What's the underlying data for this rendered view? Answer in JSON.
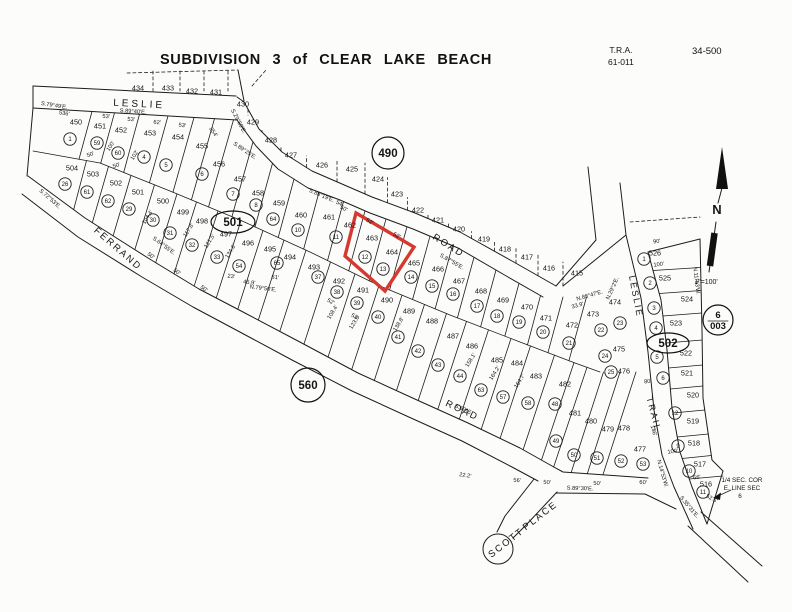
{
  "title": "SUBDIVISION 3 of CLEAR LAKE BEACH",
  "tra": {
    "label": "T.R.A.",
    "value": "61-011"
  },
  "sheet": "34-500",
  "map": {
    "north": {
      "label": "N"
    },
    "scale_note": "1\"=100'",
    "corner_note": [
      "1/4 SEC. COR",
      "E. LINE SEC",
      "6"
    ],
    "highlight": {
      "color": "#d43a2f",
      "points": "356,213 414,247 385,291 345,256",
      "lots": [
        "463",
        "464"
      ]
    },
    "refs": [
      {
        "t": "490",
        "x": 388,
        "y": 153,
        "shape": "circle",
        "rx": 16
      },
      {
        "t": "501",
        "x": 233,
        "y": 222,
        "shape": "ellipse",
        "rx": 22,
        "ry": 11
      },
      {
        "t": "560",
        "x": 308,
        "y": 385,
        "shape": "circle",
        "rx": 17
      },
      {
        "t": "502",
        "x": 668,
        "y": 343,
        "shape": "ellipse",
        "rx": 21,
        "ry": 10
      },
      {
        "t": "6",
        "t2": "003",
        "x": 718,
        "y": 320,
        "shape": "stack",
        "rx": 15
      }
    ],
    "roads": [
      {
        "t": "LESLIE",
        "x": 139,
        "y": 107,
        "r": 3,
        "fs": 10,
        "ls": 3
      },
      {
        "t": "FERRAND",
        "x": 116,
        "y": 251,
        "r": 41,
        "fs": 9.5,
        "ls": 2
      },
      {
        "t": "ROAD",
        "x": 447,
        "y": 248,
        "r": 32,
        "fs": 9.5,
        "ls": 2
      },
      {
        "t": "ROAD",
        "x": 461,
        "y": 413,
        "r": 25,
        "fs": 9.5,
        "ls": 2
      },
      {
        "t": "SCOTT",
        "x": 508,
        "y": 545,
        "r": -38,
        "fs": 9.5,
        "ls": 2
      },
      {
        "t": "PLACE",
        "x": 542,
        "y": 518,
        "r": -38,
        "fs": 9.5,
        "ls": 2
      },
      {
        "t": "LESLIE",
        "x": 633,
        "y": 297,
        "r": 79,
        "fs": 9,
        "ls": 2
      },
      {
        "t": "TRAIL",
        "x": 651,
        "y": 415,
        "r": 75,
        "fs": 9,
        "ls": 2
      }
    ],
    "boundary_lots": [
      {
        "n": "434",
        "x": 138,
        "y": 88
      },
      {
        "n": "433",
        "x": 168,
        "y": 88
      },
      {
        "n": "432",
        "x": 192,
        "y": 91
      },
      {
        "n": "431",
        "x": 216,
        "y": 92
      },
      {
        "n": "430",
        "x": 243,
        "y": 104
      },
      {
        "n": "429",
        "x": 253,
        "y": 122
      },
      {
        "n": "428",
        "x": 271,
        "y": 140
      },
      {
        "n": "427",
        "x": 291,
        "y": 155
      },
      {
        "n": "426",
        "x": 322,
        "y": 165
      },
      {
        "n": "425",
        "x": 352,
        "y": 169
      },
      {
        "n": "424",
        "x": 378,
        "y": 179
      },
      {
        "n": "423",
        "x": 397,
        "y": 194
      },
      {
        "n": "422",
        "x": 418,
        "y": 210
      },
      {
        "n": "421",
        "x": 438,
        "y": 220
      },
      {
        "n": "420",
        "x": 459,
        "y": 229
      },
      {
        "n": "419",
        "x": 484,
        "y": 239
      },
      {
        "n": "418",
        "x": 505,
        "y": 249
      },
      {
        "n": "417",
        "x": 527,
        "y": 257
      },
      {
        "n": "416",
        "x": 549,
        "y": 268
      },
      {
        "n": "415",
        "x": 577,
        "y": 273
      }
    ],
    "rows": {
      "A": [
        {
          "n": "450",
          "x": 76,
          "y": 122,
          "c": "1",
          "cx": 70,
          "cy": 139
        },
        {
          "n": "451",
          "x": 100,
          "y": 126,
          "c": "59",
          "cx": 97,
          "cy": 143
        },
        {
          "n": "452",
          "x": 121,
          "y": 130,
          "c": "60",
          "cx": 118,
          "cy": 153
        },
        {
          "n": "453",
          "x": 150,
          "y": 133,
          "c": "4",
          "cx": 144,
          "cy": 157
        },
        {
          "n": "454",
          "x": 178,
          "y": 137,
          "c": "5",
          "cx": 166,
          "cy": 165
        },
        {
          "n": "455",
          "x": 202,
          "y": 146,
          "c": "6",
          "cx": 202,
          "cy": 174
        },
        {
          "n": "456",
          "x": 219,
          "y": 164
        },
        {
          "n": "457",
          "x": 240,
          "y": 179,
          "c": "7",
          "cx": 233,
          "cy": 194
        },
        {
          "n": "458",
          "x": 258,
          "y": 193,
          "c": "8",
          "cx": 256,
          "cy": 205
        },
        {
          "n": "459",
          "x": 279,
          "y": 203,
          "c": "64",
          "cx": 273,
          "cy": 219
        },
        {
          "n": "460",
          "x": 301,
          "y": 215,
          "c": "10",
          "cx": 298,
          "cy": 230
        },
        {
          "n": "461",
          "x": 329,
          "y": 217,
          "c": "11",
          "cx": 336,
          "cy": 237
        },
        {
          "n": "462",
          "x": 350,
          "y": 225
        },
        {
          "n": "463",
          "x": 372,
          "y": 238,
          "c": "12",
          "cx": 365,
          "cy": 257
        },
        {
          "n": "464",
          "x": 392,
          "y": 252,
          "c": "13",
          "cx": 383,
          "cy": 269
        },
        {
          "n": "465",
          "x": 414,
          "y": 263,
          "c": "14",
          "cx": 411,
          "cy": 277
        },
        {
          "n": "466",
          "x": 438,
          "y": 269,
          "c": "15",
          "cx": 432,
          "cy": 286
        },
        {
          "n": "467",
          "x": 459,
          "y": 281,
          "c": "16",
          "cx": 453,
          "cy": 294
        },
        {
          "n": "468",
          "x": 481,
          "y": 291,
          "c": "17",
          "cx": 477,
          "cy": 306
        },
        {
          "n": "469",
          "x": 503,
          "y": 300,
          "c": "18",
          "cx": 497,
          "cy": 316
        },
        {
          "n": "470",
          "x": 527,
          "y": 307,
          "c": "19",
          "cx": 519,
          "cy": 322
        },
        {
          "n": "471",
          "x": 546,
          "y": 318,
          "c": "20",
          "cx": 543,
          "cy": 332
        },
        {
          "n": "472",
          "x": 572,
          "y": 325,
          "c": "21",
          "cx": 569,
          "cy": 343
        },
        {
          "n": "473",
          "x": 593,
          "y": 314,
          "c": "22",
          "cx": 601,
          "cy": 330
        },
        {
          "n": "474",
          "x": 615,
          "y": 302,
          "c": "23",
          "cx": 620,
          "cy": 323
        },
        {
          "n": "475",
          "x": 619,
          "y": 349,
          "c": "24",
          "cx": 605,
          "cy": 356
        },
        {
          "n": "476",
          "x": 624,
          "y": 371,
          "c": "25",
          "cx": 611,
          "cy": 372
        }
      ],
      "B": [
        {
          "n": "504",
          "x": 72,
          "y": 168,
          "c": "26",
          "cx": 65,
          "cy": 184
        },
        {
          "n": "503",
          "x": 93,
          "y": 174,
          "c": "61",
          "cx": 87,
          "cy": 192
        },
        {
          "n": "502",
          "x": 116,
          "y": 183,
          "c": "62",
          "cx": 108,
          "cy": 201
        },
        {
          "n": "501",
          "x": 138,
          "y": 192,
          "c": "29",
          "cx": 129,
          "cy": 209
        },
        {
          "n": "500",
          "x": 163,
          "y": 201,
          "c": "30",
          "cx": 153,
          "cy": 220
        },
        {
          "n": "499",
          "x": 183,
          "y": 212,
          "c": "31",
          "cx": 170,
          "cy": 233
        },
        {
          "n": "498",
          "x": 202,
          "y": 221,
          "c": "32",
          "cx": 192,
          "cy": 245
        },
        {
          "n": "497",
          "x": 226,
          "y": 234,
          "c": "33",
          "cx": 217,
          "cy": 257
        },
        {
          "n": "496",
          "x": 248,
          "y": 243,
          "c": "54",
          "cx": 239,
          "cy": 266
        },
        {
          "n": "495",
          "x": 270,
          "y": 249,
          "c": "65",
          "cx": 277,
          "cy": 263
        },
        {
          "n": "494",
          "x": 290,
          "y": 257
        },
        {
          "n": "493",
          "x": 314,
          "y": 267,
          "c": "37",
          "cx": 318,
          "cy": 277
        },
        {
          "n": "492",
          "x": 339,
          "y": 281,
          "c": "38",
          "cx": 337,
          "cy": 292
        },
        {
          "n": "491",
          "x": 363,
          "y": 290,
          "c": "39",
          "cx": 357,
          "cy": 303
        },
        {
          "n": "490",
          "x": 387,
          "y": 300,
          "c": "40",
          "cx": 378,
          "cy": 317
        },
        {
          "n": "489",
          "x": 409,
          "y": 311,
          "c": "41",
          "cx": 398,
          "cy": 337
        },
        {
          "n": "488",
          "x": 432,
          "y": 321,
          "c": "42",
          "cx": 418,
          "cy": 351
        },
        {
          "n": "487",
          "x": 453,
          "y": 336,
          "c": "43",
          "cx": 438,
          "cy": 365
        },
        {
          "n": "486",
          "x": 472,
          "y": 346,
          "c": "44",
          "cx": 460,
          "cy": 376
        },
        {
          "n": "485",
          "x": 497,
          "y": 360,
          "c": "63",
          "cx": 481,
          "cy": 390
        },
        {
          "n": "484",
          "x": 517,
          "y": 363,
          "c": "57",
          "cx": 503,
          "cy": 397
        },
        {
          "n": "483",
          "x": 536,
          "y": 376,
          "c": "58",
          "cx": 528,
          "cy": 403
        },
        {
          "n": "482",
          "x": 565,
          "y": 384,
          "c": "48",
          "cx": 555,
          "cy": 404
        },
        {
          "n": "481",
          "x": 575,
          "y": 413,
          "c": "49",
          "cx": 556,
          "cy": 441
        },
        {
          "n": "480",
          "x": 591,
          "y": 421,
          "c": "50",
          "cx": 574,
          "cy": 455
        },
        {
          "n": "479",
          "x": 608,
          "y": 429,
          "c": "51",
          "cx": 597,
          "cy": 458
        },
        {
          "n": "478",
          "x": 624,
          "y": 428,
          "c": "52",
          "cx": 621,
          "cy": 461
        },
        {
          "n": "477",
          "x": 640,
          "y": 449,
          "c": "53",
          "cx": 643,
          "cy": 464
        }
      ],
      "C": [
        {
          "n": "526",
          "x": 655,
          "y": 253,
          "c": "1",
          "cx": 644,
          "cy": 259
        },
        {
          "n": "525",
          "x": 665,
          "y": 278,
          "c": "2",
          "cx": 650,
          "cy": 283
        },
        {
          "n": "524",
          "x": 687,
          "y": 299,
          "c": "3",
          "cx": 654,
          "cy": 308
        },
        {
          "n": "523",
          "x": 676,
          "y": 323,
          "c": "4",
          "cx": 656,
          "cy": 328
        },
        {
          "n": "522",
          "x": 686,
          "y": 353,
          "c": "5",
          "cx": 657,
          "cy": 357
        },
        {
          "n": "521",
          "x": 687,
          "y": 373,
          "c": "6",
          "cx": 663,
          "cy": 378
        },
        {
          "n": "520",
          "x": 693,
          "y": 395
        },
        {
          "n": "519",
          "x": 693,
          "y": 421,
          "c": "12",
          "cx": 675,
          "cy": 413
        },
        {
          "n": "518",
          "x": 694,
          "y": 443,
          "c": "9",
          "cx": 678,
          "cy": 446
        },
        {
          "n": "517",
          "x": 700,
          "y": 464,
          "c": "10",
          "cx": 689,
          "cy": 471
        },
        {
          "n": "516",
          "x": 706,
          "y": 484,
          "c": "11",
          "cx": 703,
          "cy": 492
        }
      ]
    },
    "dims": [
      {
        "t": "S.79°49'E.",
        "x": 54,
        "y": 107,
        "r": 9
      },
      {
        "t": "536'",
        "x": 64,
        "y": 115,
        "r": 9
      },
      {
        "t": "S.89°40'E.",
        "x": 133,
        "y": 113,
        "r": 4
      },
      {
        "t": "53'",
        "x": 106,
        "y": 118,
        "r": 4
      },
      {
        "t": "53'",
        "x": 131,
        "y": 121,
        "r": 4
      },
      {
        "t": "62'",
        "x": 157,
        "y": 124,
        "r": 6
      },
      {
        "t": "53'",
        "x": 182,
        "y": 127,
        "r": 8
      },
      {
        "t": "254'",
        "x": 212,
        "y": 133,
        "r": 55
      },
      {
        "t": "S.29°59'E.",
        "x": 237,
        "y": 122,
        "r": 62
      },
      {
        "t": "S.89°25'E.",
        "x": 244,
        "y": 152,
        "r": 34
      },
      {
        "t": "S.88°19'E.",
        "x": 321,
        "y": 197,
        "r": 23
      },
      {
        "t": "54'",
        "x": 339,
        "y": 205,
        "r": 23
      },
      {
        "t": "S.87°55'E.",
        "x": 451,
        "y": 263,
        "r": 30
      },
      {
        "t": "S.72°53'E.",
        "x": 49,
        "y": 200,
        "r": 41
      },
      {
        "t": "S.64°55'E.",
        "x": 163,
        "y": 247,
        "r": 36
      },
      {
        "t": "N.79°50'E.",
        "x": 263,
        "y": 290,
        "r": 7
      },
      {
        "t": "23'",
        "x": 231,
        "y": 278,
        "r": 7
      },
      {
        "t": "45.9'",
        "x": 249,
        "y": 284,
        "r": 7
      },
      {
        "t": "61'",
        "x": 275,
        "y": 279,
        "r": 7
      },
      {
        "t": "N.88°47'E.",
        "x": 590,
        "y": 297,
        "r": -16
      },
      {
        "t": "33.9'",
        "x": 578,
        "y": 307,
        "r": -16
      },
      {
        "t": "N.29°2'E.",
        "x": 614,
        "y": 289,
        "r": -66
      },
      {
        "t": "S.89°30'E.",
        "x": 580,
        "y": 490,
        "r": 2
      },
      {
        "t": "S.69°E.",
        "x": 463,
        "y": 411,
        "r": 24
      },
      {
        "t": "N.11°53'W.",
        "x": 695,
        "y": 281,
        "r": 83
      },
      {
        "t": "N.14°53'W.",
        "x": 661,
        "y": 474,
        "r": 74
      },
      {
        "t": "S.35°31'E.",
        "x": 688,
        "y": 508,
        "r": 50
      },
      {
        "t": "52.6'",
        "x": 711,
        "y": 500,
        "r": 28
      },
      {
        "t": "100'",
        "x": 659,
        "y": 266,
        "r": -8
      },
      {
        "t": "90'",
        "x": 657,
        "y": 243,
        "r": -8
      },
      {
        "t": "100'",
        "x": 673,
        "y": 453,
        "r": -8
      },
      {
        "t": "66'",
        "x": 697,
        "y": 479,
        "r": -5
      },
      {
        "t": "80'",
        "x": 648,
        "y": 383,
        "r": -8
      },
      {
        "t": "146'",
        "x": 652,
        "y": 431,
        "r": 74
      },
      {
        "t": "100'",
        "x": 112,
        "y": 147,
        "r": -58
      },
      {
        "t": "102'",
        "x": 136,
        "y": 156,
        "r": -58
      },
      {
        "t": "104.4'",
        "x": 149,
        "y": 218,
        "r": -58
      },
      {
        "t": "117.8'",
        "x": 190,
        "y": 231,
        "r": -58
      },
      {
        "t": "121.5'",
        "x": 211,
        "y": 242,
        "r": -58
      },
      {
        "t": "134.6'",
        "x": 232,
        "y": 252,
        "r": -58
      },
      {
        "t": "108.4'",
        "x": 334,
        "y": 313,
        "r": -58
      },
      {
        "t": "123.6'",
        "x": 356,
        "y": 323,
        "r": -58
      },
      {
        "t": "138.8'",
        "x": 400,
        "y": 325,
        "r": -58
      },
      {
        "t": "158.1'",
        "x": 472,
        "y": 361,
        "r": -58
      },
      {
        "t": "164.2'",
        "x": 496,
        "y": 374,
        "r": -58
      },
      {
        "t": "164.7'",
        "x": 521,
        "y": 382,
        "r": -58
      },
      {
        "t": "50'",
        "x": 150,
        "y": 257,
        "r": 36
      },
      {
        "t": "50'",
        "x": 176,
        "y": 273,
        "r": 36
      },
      {
        "t": "50'",
        "x": 203,
        "y": 290,
        "r": 36
      },
      {
        "t": "52'",
        "x": 330,
        "y": 303,
        "r": 29
      },
      {
        "t": "52'",
        "x": 354,
        "y": 318,
        "r": 29
      },
      {
        "t": "50'",
        "x": 343,
        "y": 210,
        "r": 28
      },
      {
        "t": "52'",
        "x": 369,
        "y": 223,
        "r": 28
      },
      {
        "t": "52'",
        "x": 396,
        "y": 237,
        "r": 28
      },
      {
        "t": "22.2'",
        "x": 465,
        "y": 477,
        "r": 8
      },
      {
        "t": "56'",
        "x": 517,
        "y": 482,
        "r": 3
      },
      {
        "t": "50'",
        "x": 547,
        "y": 484,
        "r": 3
      },
      {
        "t": "50'",
        "x": 597,
        "y": 485,
        "r": 3
      },
      {
        "t": "60'",
        "x": 643,
        "y": 484,
        "r": 3
      },
      {
        "t": "50'",
        "x": 91,
        "y": 156,
        "r": -20
      },
      {
        "t": "50'",
        "x": 117,
        "y": 167,
        "r": -20
      }
    ]
  }
}
